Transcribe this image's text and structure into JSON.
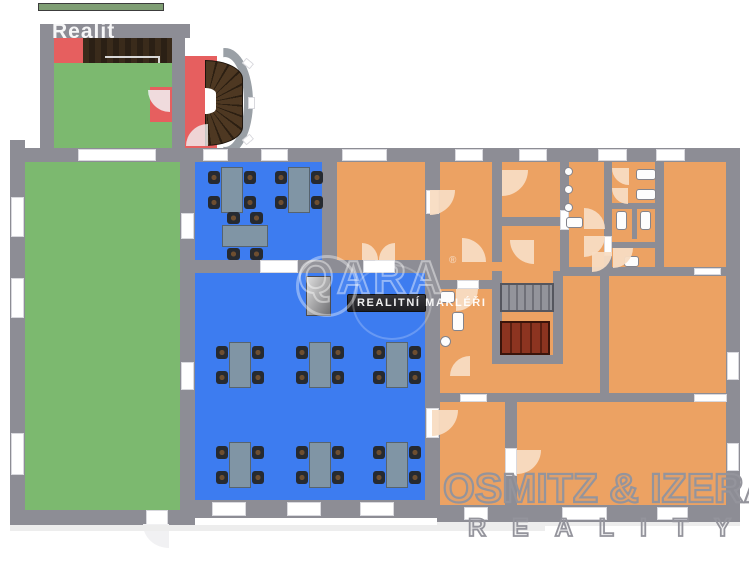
{
  "watermarks": {
    "corner": "Realit",
    "center_logo": "QARA",
    "center_logo_mark": "®",
    "center_sub": "REALITNÍ MAKLÉŘI",
    "agency_name": "OSMITZ & IZERA",
    "agency_sub": "REALITY"
  },
  "palette": {
    "wall": "#8d8d95",
    "room_green": "#7cb96f",
    "room_blue": "#3d7cf0",
    "room_orange": "#eca263",
    "room_red": "#e65f5f",
    "deck_dark": "#2b2015",
    "stair_wood": "#8c3420",
    "stair_grey": "#8f9096",
    "door_arc": "#f8dcc2",
    "table_top": "#8095a5",
    "chair": "#262a31",
    "counter_dark": "#35353a",
    "watermark_grey": "#94949c"
  }
}
